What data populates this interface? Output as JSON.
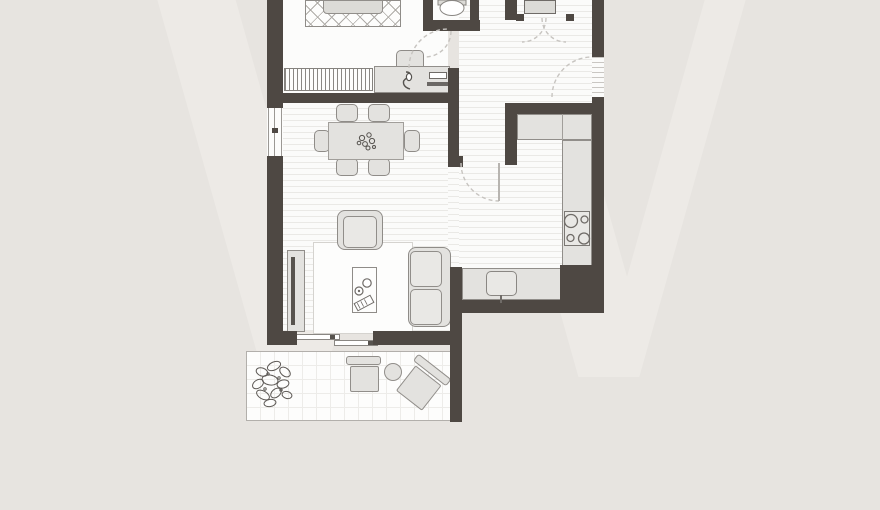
{
  "watermark": {
    "text": "W"
  },
  "colors": {
    "background": "#e7e4e0",
    "watermark": "#edeae6",
    "wall": "#4e4843",
    "floor": "#fbfbfa",
    "floor-line": "#eae9e6",
    "furniture-fill": "#e3e2df",
    "furniture-border": "#918e8a",
    "balcony-line": "#b2afab",
    "door-arc": "#c7c4c0",
    "detail-stroke": "#6f6b67"
  },
  "plan": {
    "type": "apartment-floor-plan",
    "rooms": {
      "bedroom": {
        "furniture": [
          "bed",
          "zigzag-rug",
          "wardrobe",
          "desk",
          "desk-chair",
          "laptop"
        ]
      },
      "wc": {
        "furniture": [
          "toilet"
        ]
      },
      "hall": {
        "furniture": [
          "closet-cabinet",
          "entrance-door",
          "closet-double-doors"
        ]
      },
      "kitchen": {
        "furniture": [
          "l-counter",
          "stove-4-burners",
          "sink-counter",
          "sink"
        ]
      },
      "living-dining": {
        "furniture": [
          "dining-table",
          "dining-chairs-6",
          "centerpiece-plant",
          "armchair",
          "sofa",
          "coffee-table",
          "cups",
          "remote",
          "tv-sideboard",
          "area-rug",
          "sliding-door"
        ]
      },
      "balcony": {
        "furniture": [
          "plant",
          "lounge-chair",
          "round-side-table",
          "tilted-lounge-chair"
        ]
      }
    }
  }
}
